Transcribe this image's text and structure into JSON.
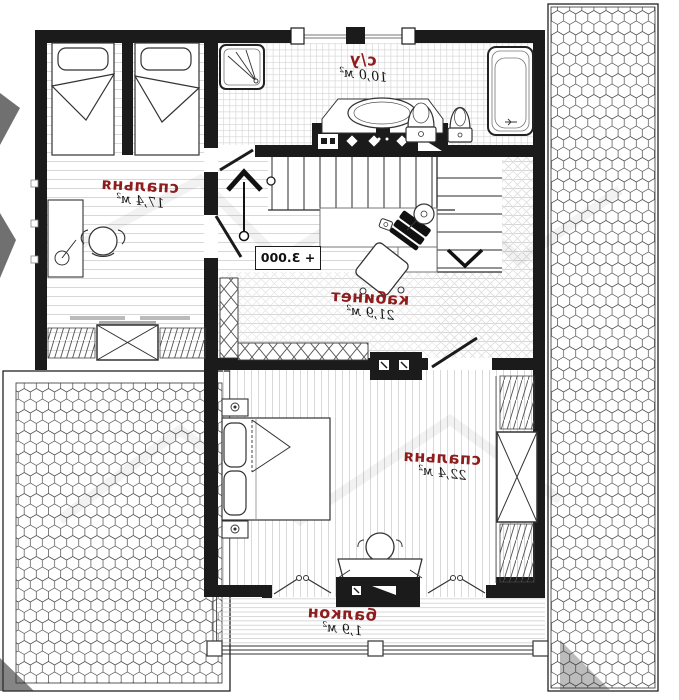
{
  "plan": {
    "level_mark": "+ 3.000",
    "rooms": {
      "bedroom1": {
        "name": "спальня",
        "area": "17,4 м²"
      },
      "bathroom": {
        "name": "с/у",
        "area": "10,0 м²"
      },
      "study": {
        "name": "кабинет",
        "area": "21,9 м²"
      },
      "bedroom2": {
        "name": "спальня",
        "area": "22,4 м²"
      },
      "balcony": {
        "name": "балкон",
        "area": "1,9 м²"
      }
    },
    "colors": {
      "wall": "#1b1b1b",
      "room_label": "#8f1d1d",
      "floor_line": "#d6d6d6",
      "hex_line": "#4a4a4a"
    }
  }
}
